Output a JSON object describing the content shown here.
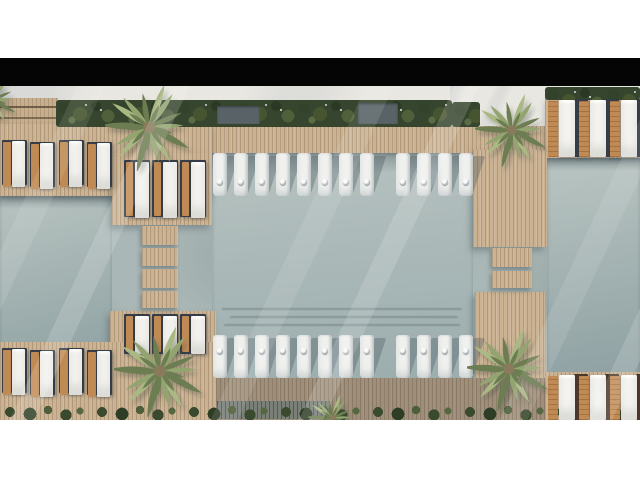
{
  "meta": {
    "description": "Top-down aerial 3D architectural rendering of a resort swimming pool complex: pale grey-green pools framed by light timber decks, rows of white in-pool ledge loungers, paired wood-and-white sun loungers on the terraces, dense planting strips and palm trees at the deck corners. Black letterbox bar above the render, white margins top and bottom.",
    "view": "aerial top-down render",
    "letterbox": {
      "top_bar": true,
      "bottom_area": "white"
    }
  },
  "palette": {
    "page_bg": "#ffffff",
    "letterbox": "#050505",
    "pavement": "#e9e7e1",
    "water_light": "#bcc7c4",
    "water_mid": "#a6b5b5",
    "water_deep": "#8da0a2",
    "deck_wood": "#cab293",
    "deck_wood_line": "#8a7354",
    "deck_shaded": "#a3937e",
    "hedge_green": "#36452d",
    "palm_green": "#93a471",
    "palm_green_dark": "#6c7d52",
    "palm_green_light": "#aab884",
    "palm_core": "#8a7a5c",
    "chaise_white": "#f4f3ef",
    "chaise_wood": "#c08a54",
    "mat_dark": "#363d46",
    "mat_brown": "#4c3829",
    "ball_white": "#fbfbfb"
  },
  "scene": {
    "pools": [
      "left",
      "central",
      "right"
    ],
    "in_pool_loungers": {
      "rows": [
        {
          "name": "top-row",
          "groups": [
            8,
            4
          ]
        },
        {
          "name": "bottom-row",
          "groups": [
            8,
            4
          ]
        }
      ]
    },
    "deck_loungers": {
      "terrace_top_left": 4,
      "platform_left_top": 3,
      "terrace_top_right": 3,
      "terrace_bottom_left": 4,
      "platform_left_bottom": 3,
      "terrace_bottom_right": 3
    },
    "palm_trees": {
      "count": 4,
      "positions": [
        "top-left",
        "top-right",
        "bottom-left",
        "bottom-right"
      ]
    },
    "walkways": {
      "left_segments": 4,
      "right_segments": 2
    }
  }
}
